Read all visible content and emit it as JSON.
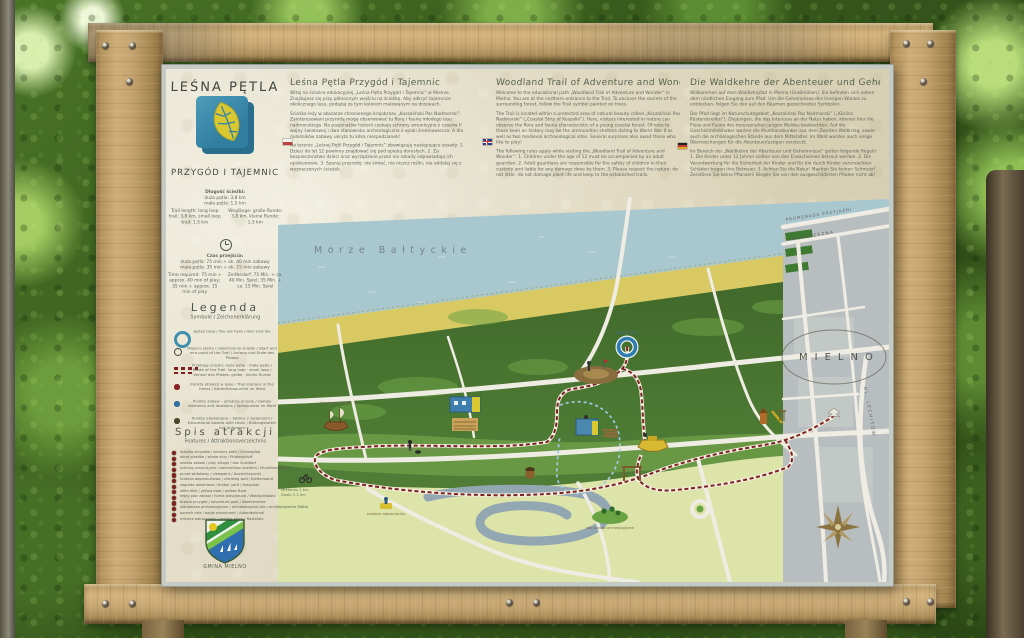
{
  "header": {
    "title1": "LEŚNA PĘTLA",
    "title2": "PRZYGÓD I TAJEMNIC"
  },
  "intro": {
    "pl": {
      "heading": "Leśna Pętla Przygód i Tajemnic",
      "p1": "Witaj na ścieżce edukacyjnej „Leśna Pętla Przygód i Tajemnic” w Mielnie. Znajdujesz się przy północnym wejściu na ścieżkę. Aby odkryć tajemnice okolicznego lasu, podążaj za tym kolorem malowanym na drzewach.",
      "p2": "Ścieżka leży w obszarze chronionego krajobrazu „Koszaliński Pas Nadmorski”. Zainteresowani przyrodą mogą obserwować tu florę i faunę młodego lasu nadmorskiego. Na pasjonatów historii czekają schrony amunicyjne z czasów II wojny światowej i dwa stanowiska archeologiczne z epoki średniowiecza. A dla miłośników zabawy ukryto tu kilka niespodzianek!",
      "p3": "Na terenie „Leśnej Pętli Przygód i Tajemnic” obowiązują następujące zasady: 1. Dzieci do lat 12 powinny znajdować się pod opieką dorosłych. 2. Za bezpieczeństwo dzieci oraz wyrządzone przez nie szkody odpowiadają ich opiekunowie. 3. Szanuj przyrodę: nie śmieć, nie niszcz roślin, nie oddalaj się z wyznaczonych ścieżek."
    },
    "en": {
      "heading": "Woodland Trail of Adventure and Wonder",
      "p1": "Welcome to the educational path „Woodland Trail of Adventure and Wonder” in Mielno. You are at the northern entrance to the Trail. To uncover the secrets of the surrounding forest, follow the Trail symbol painted on trees.",
      "p2": "The Trail is located within a protected area of natural beauty called „Koszaliński Pas Nadmorski” („Coastal Strip of Koszalin”). Here, visitors interested in nature can observe the flora and fauna characteristic of a young coastal forest. Of note to those keen on history may be the ammunition shelters dating to World War II as well as two medieval archaeological sites. Several surprises also await those who like to play!",
      "p3": "The following rules apply while visiting the „Woodland Trail of Adventure and Wonder”: 1. Children under the age of 12 must be accompanied by an adult guardian. 2. Adult guardians are responsible for the safety of children in their custody and liable for any damage done by them. 3. Please respect the nature: do not litter, do not damage plant life and keep to the established trails."
    },
    "de": {
      "heading": "Die Waldkehre der Abenteuer und Geheimnisse",
      "p1": "Willkommen auf dem Waldlehrpfad in Mielno (Großmöllen). Sie befinden sich neben dem nördlichen Eingang zum Pfad. Um die Geheimnisse des hiesigen Waldes zu entdecken, folgen Sie den auf den Bäumen gezeichneten Symbolen.",
      "p2": "Der Pfad liegt im Naturschutzgebiet „Koszaliński Pas Nadmorski” („Köslins Küstenstreifen”). Diejenigen, die das Interesse an der Natur haben, können hier die Flora und Fauna des meeresnahen jungen Waldes beobachten. Auf die Geschichtsliebhaber warten die Munitionsbunker aus dem Zweiten Weltkrieg, sowie auch die archäologischen Stände aus dem Mittelalter. Im Wald wurden auch einige Überraschungen für die Abenteuerlustigen versteckt.",
      "p3": "Im Bereich der „Waldkehre der Abenteuer und Geheimnisse” gelten folgende Regeln: 1. Die Kinder unter 12 Jahren sollten von den Erwachsenen betreut werden. 2. Die Verantwortung für die Sicherheit der Kinder und für die durch Kinder verursachten Schäden tragen ihre Betreuer. 3. Achten Sie die Natur! Machen Sie keinen Schmutz! Zerstören Sie keine Pflanzen! Biegen Sie von den ausgeschilderten Pfaden nicht ab!"
    }
  },
  "info": {
    "length_title": "Długość ścieżki:",
    "length_l1": "duża pętla: 3,8 km",
    "length_l2": "mała pętla: 1,5 km",
    "length_en": "Trail length: long loop trail: 3,8 km, small loop trail: 1,5 km",
    "length_de": "Weglänge: große Runde: 3,8 km, kleine Runde: 1,5 km",
    "time_title": "Czas przejścia:",
    "time_l1": "duża pętla: 75 min + ok. 40 min zabawy",
    "time_l2": "mała pętla: 35 min + ok. 15 min zabawy",
    "time_en": "Time required: 75 min + approx. 40 min of play; 35 min + approx. 15 min of play",
    "time_de": "Zeitbedarf: 75 Min. + ca. 40 Min. Spiel; 35 Min. + ca. 15 Min. Spiel"
  },
  "legend": {
    "title": "Legenda",
    "subtitle": "Symbole / Zeichenerklärung",
    "items": [
      {
        "text": "Jesteś tutaj / You are here / Hier sind Sie"
      },
      {
        "text": "Miejsce startu i zakończenia ścieżki / Start and end point of the Trail / Anfang und Ende des Pfades"
      },
      {
        "text": "Przebieg ścieżki: duża pętla · mała pętla / Route of the Trail: long loop · small loop / Verlauf des Pfades: große · kleine Runde"
      },
      {
        "text": "Punkty atrakcji w lesie / Trail stations in the forest / Attraktionspunkte im Wald"
      },
      {
        "text": "Punkty zabaw – atrakcje w lesie / Games elements and locations / Spielpunkte im Wald"
      },
      {
        "text": "Punkty edukacyjne – tablice z zadaniami / Educational boards with tasks / Bildungstafeln mit Aufgaben"
      }
    ]
  },
  "attractions": {
    "title": "Spis atrakcji",
    "subtitle": "Features / Attraktionsverzeichnis",
    "items": [
      "ścieżka zmysłów / sensory path / Sinnespfad",
      "okręt piratów / pirate ship / Piratenschiff",
      "wioska zabaw / play village / das Spieldorf",
      "schrony amunicyjne / ammunition shelters / Munitionsbunker",
      "punkt widokowy / viewpoint / Aussichtspunkt",
      "ścianka wspinaczkowa / climbing wall / Kletterwand",
      "zagroda drewniana / timber yard / Holzplatz",
      "żółta łódź / yellow boat / gelbes Boot",
      "leśny plac zabaw / forest playground / Waldspielplatz",
      "brama przygód / adventure gate / Abenteuertor",
      "stanowisko archeologiczne / archaeological site / archäologische Stätte",
      "pomnik orła / eagle monument / Adlerdenkmal",
      "miejsce odpoczynku / resting place / Rastplatz"
    ]
  },
  "municipality": "GMINA MIELNO",
  "map": {
    "sea": "Morze Bałtyckie",
    "town": "MIELNO",
    "promenade": "PROMENADA PRZYJAŹNI",
    "street1": "NADBRZEŻNA",
    "street2": "UL. LECHITÓW",
    "road": "Szlak rowerowy",
    "directions1": "Mielenko 1 km",
    "directions2": "Gąski 2,2 km",
    "you_are_here": "jesteś tutaj",
    "label_ship": "ścieżka zmysłów",
    "label_rest": "miejsce odpoczynku",
    "label_arch": "stanowisko archeologiczne"
  },
  "colors": {
    "trail_red": "#7c2020",
    "sea_blue": "#a9c7cf",
    "beach_yellow": "#d8c963",
    "forest_green": "#4a7831",
    "logo_blue": "#3b8cab",
    "leaf_yellow": "#d9c832"
  }
}
